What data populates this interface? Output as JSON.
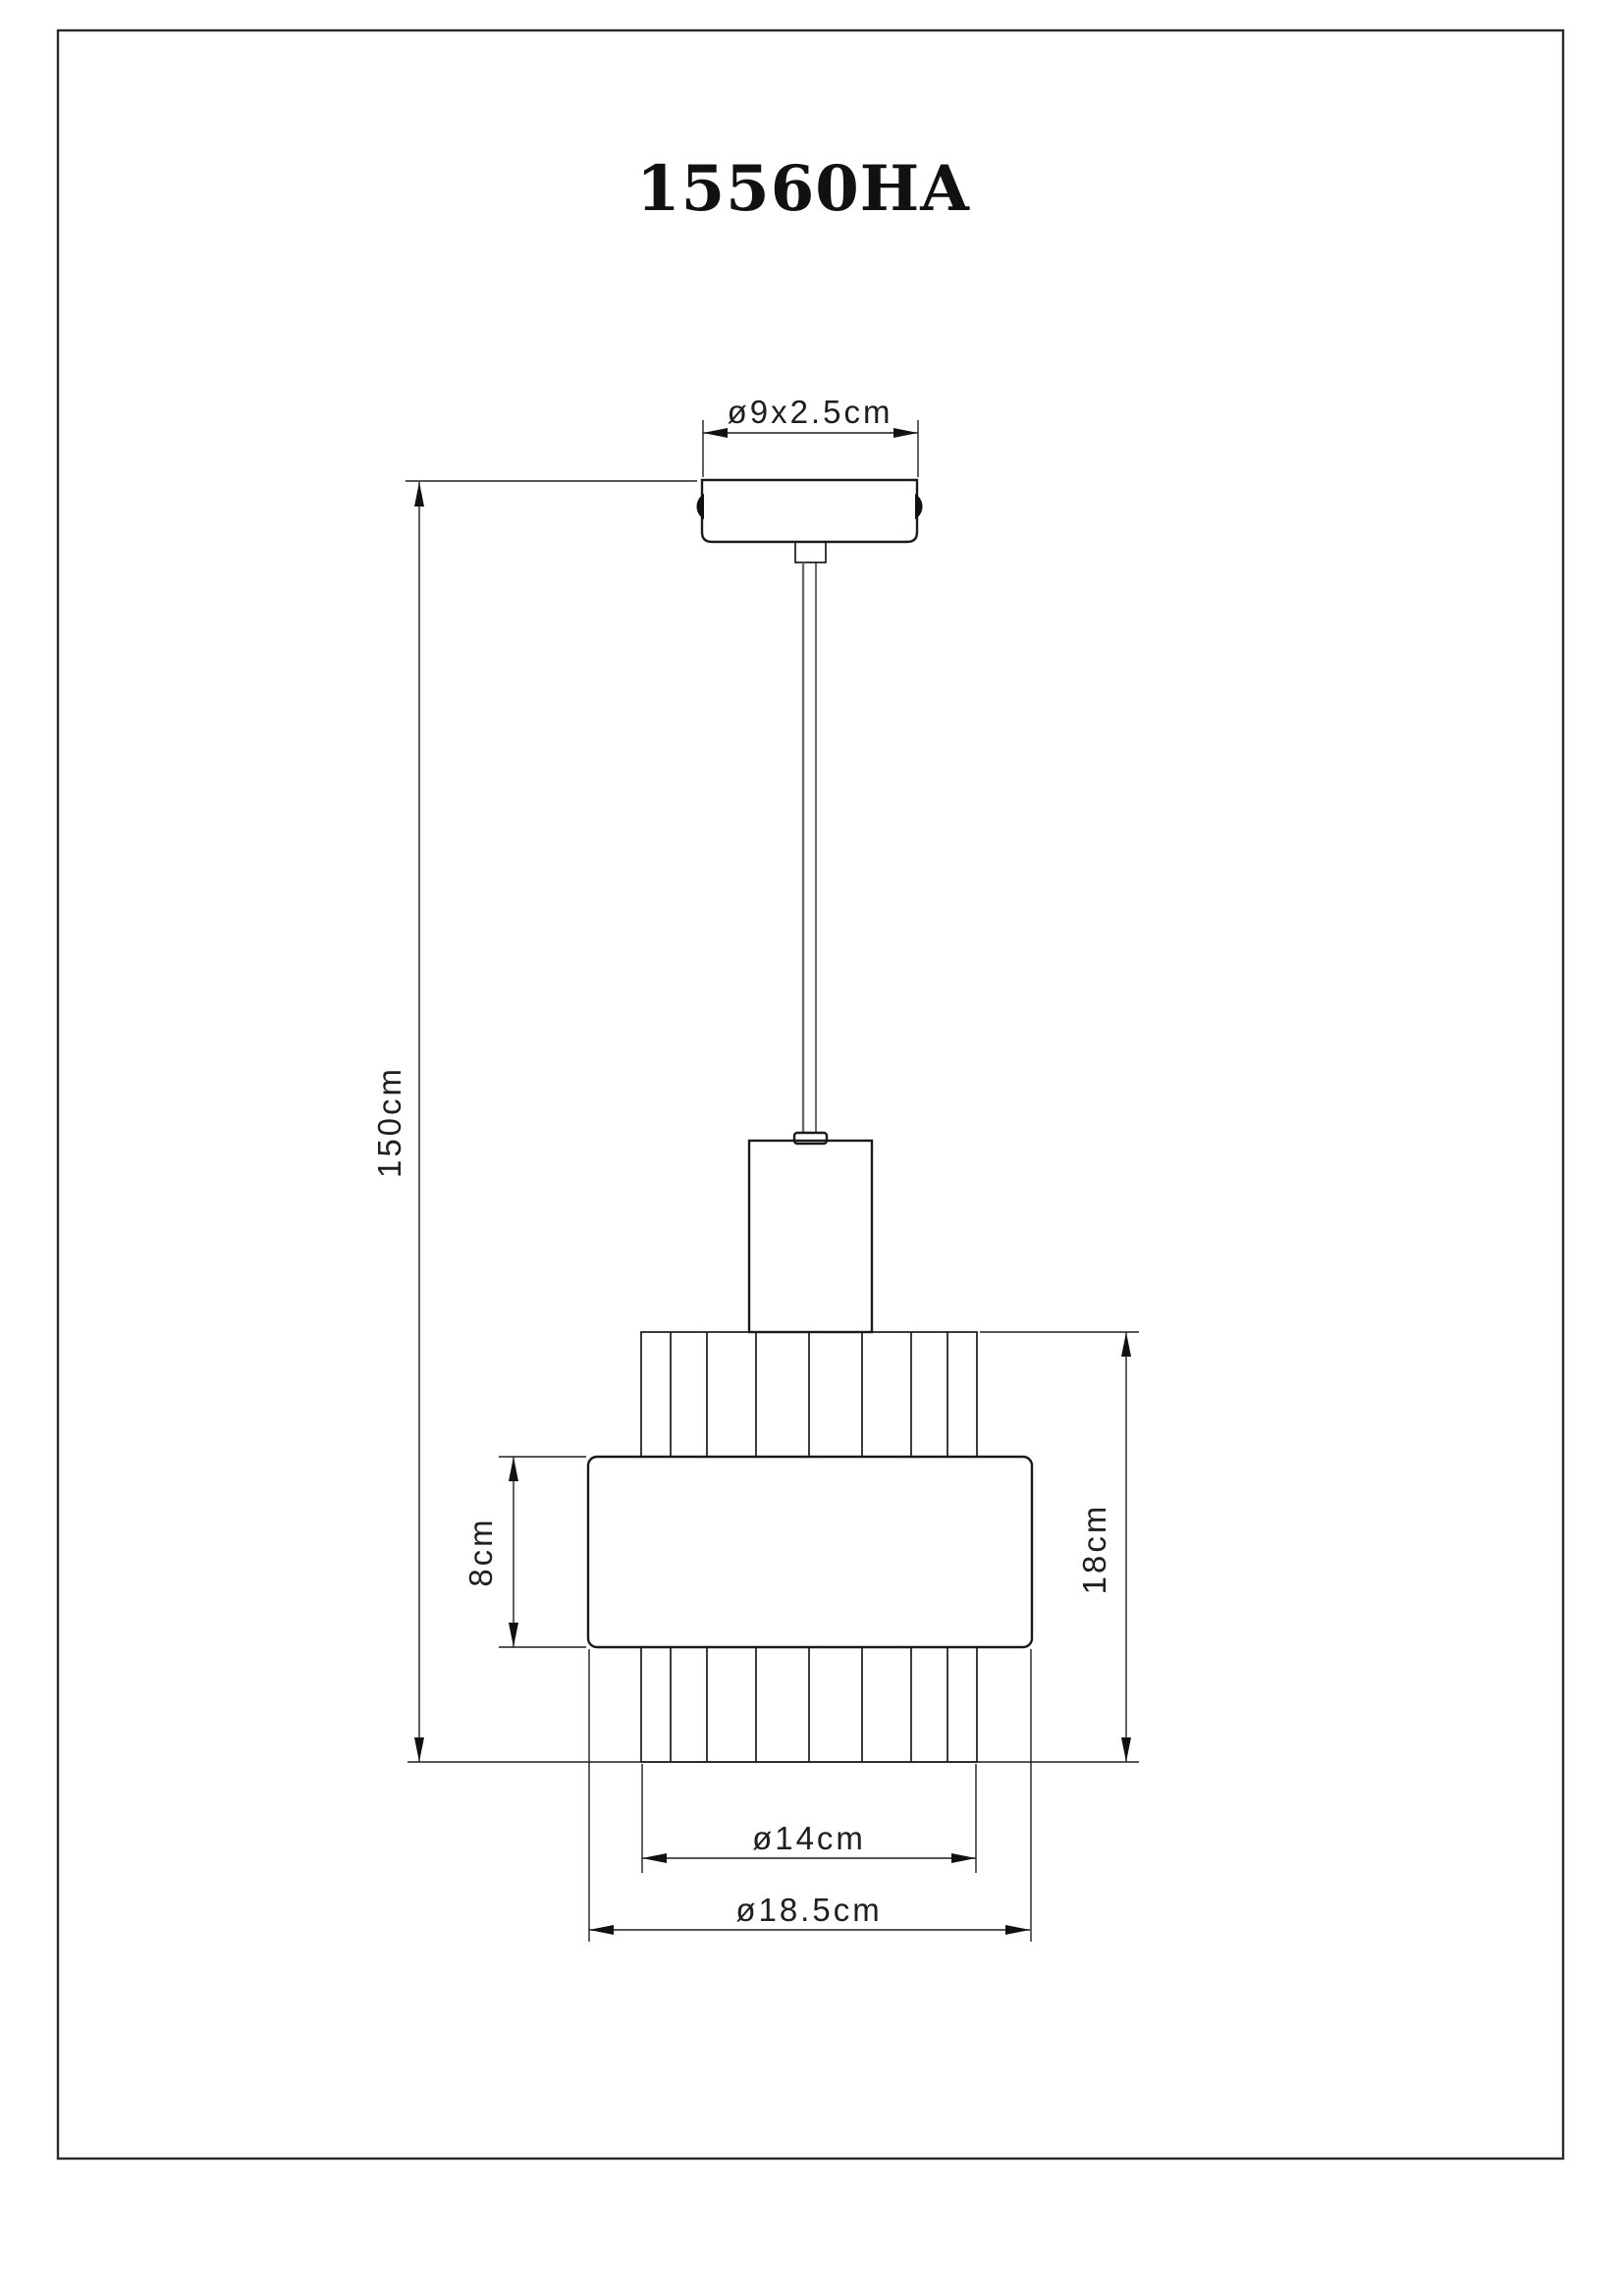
{
  "page": {
    "title": "15560HA",
    "background": "#ffffff",
    "line_color": "#1a1a1a"
  },
  "labels": {
    "canopy_size": "ø9x2.5cm",
    "drop_height": "150cm",
    "band_height": "8cm",
    "shade_height": "18cm",
    "shade_inner_diameter": "ø14cm",
    "shade_outer_diameter": "ø18.5cm"
  }
}
